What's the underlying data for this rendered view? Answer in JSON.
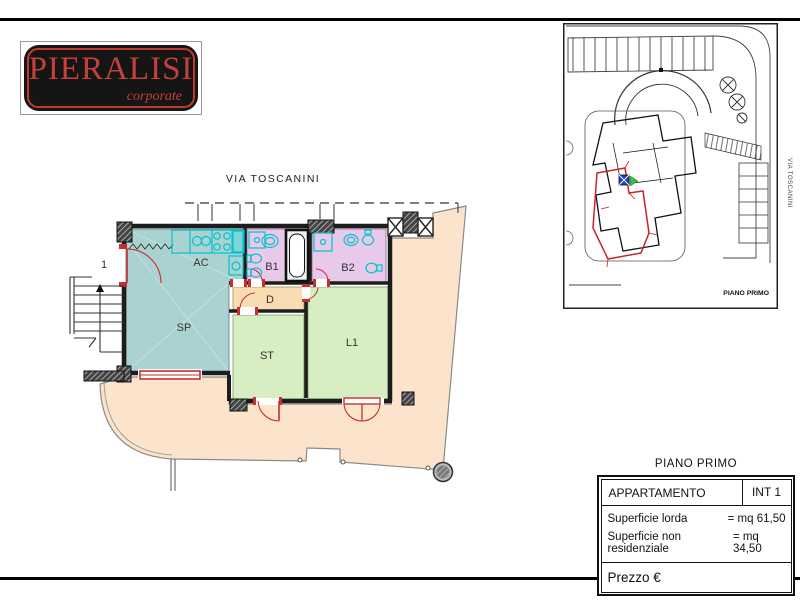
{
  "logo": {
    "brand": "PIERALISI",
    "tagline": "corporate",
    "bg": "#151515",
    "red": "#c4403a"
  },
  "floor_plan": {
    "street_label": "VIA TOSCANINI",
    "rooms": [
      {
        "id": "stairwell",
        "label": "1",
        "color": "#ffffff"
      },
      {
        "id": "soggiorno-pranzo",
        "label": "SP",
        "color": "#a9d2d0"
      },
      {
        "id": "angolo-cottura",
        "label": "AC",
        "color": "#a9d2d0"
      },
      {
        "id": "bagno-1",
        "label": "B1",
        "color": "#e9c9e9"
      },
      {
        "id": "bagno-2",
        "label": "B2",
        "color": "#e9c9e9"
      },
      {
        "id": "disimpegno",
        "label": "D",
        "color": "#f8ddb2"
      },
      {
        "id": "studio",
        "label": "ST",
        "color": "#d6eec2"
      },
      {
        "id": "letto-1",
        "label": "L1",
        "color": "#d6eec2"
      }
    ],
    "colors": {
      "walls": "#1d1d1d",
      "terrace": "#fbe4cb",
      "fixtures": "#00c3cf",
      "accent_red": "#c52f2f"
    }
  },
  "site_inset": {
    "floor_label": "PIANO PRIMO",
    "street_label": "VIA TOSCANINI",
    "highlight_color": "#cc2222",
    "marker_color": "#1e3fd0"
  },
  "info_table": {
    "title": "PIANO PRIMO",
    "apartment_label": "APPARTAMENTO",
    "unit_label": "INT 1",
    "rows": [
      {
        "label": "Superficie lorda",
        "value": "= mq 61,50"
      },
      {
        "label": "Superficie non residenziale",
        "value": "= mq 34,50"
      }
    ],
    "price_label": "Prezzo €"
  }
}
